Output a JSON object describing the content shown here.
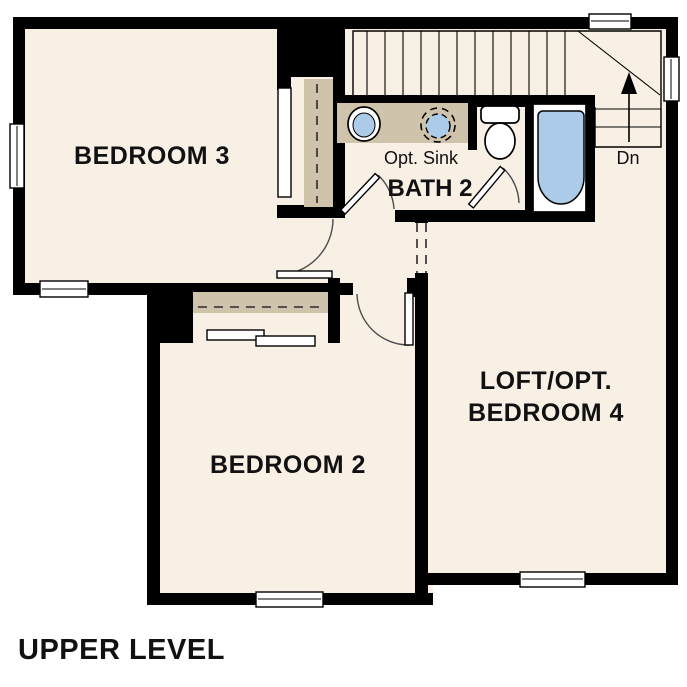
{
  "title": "UPPER LEVEL",
  "plan_type": "residential floor plan, upper level",
  "colors": {
    "wall": "#000000",
    "floor": "#f8efe5",
    "cabinet": "#d0c3ab",
    "fixture_blue": "#abcbe9",
    "background": "#ffffff"
  },
  "rooms": {
    "bedroom3": {
      "label": "BEDROOM 3"
    },
    "bedroom2": {
      "label": "BEDROOM 2"
    },
    "bath2": {
      "label": "BATH 2"
    },
    "loft": {
      "label_line1": "LOFT/OPT.",
      "label_line2": "BEDROOM 4"
    }
  },
  "annotations": {
    "opt_sink": "Opt. Sink",
    "stairs_down": "Dn"
  },
  "icons": {
    "stair_direction_arrow": "up-triangle"
  },
  "fixtures": [
    "vanity with sink",
    "optional second sink (dashed)",
    "toilet",
    "bathtub",
    "bedroom 3 closet with sliding panel",
    "bedroom 2 closet with bypass doors",
    "staircase with winder treads going down"
  ]
}
